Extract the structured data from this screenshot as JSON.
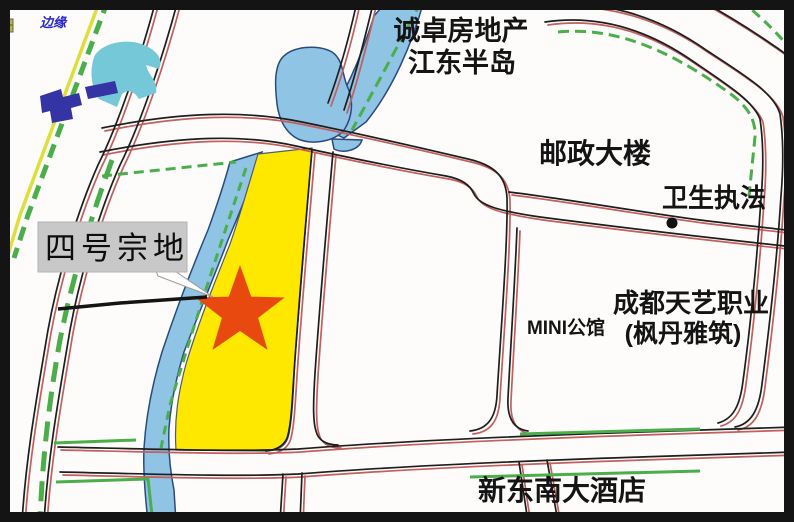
{
  "map": {
    "legend": {
      "label": "边缘"
    },
    "parcel": {
      "name": "四号宗地"
    },
    "pois": {
      "developer": {
        "line1": "诚卓房地产",
        "line2": "江东半岛"
      },
      "post_office": "邮政大楼",
      "health_enforcement": "卫生执法",
      "mini_mansion": "MINI公馆",
      "tianyi_college": {
        "line1": "成都天艺职业",
        "line2": "(枫丹雅筑)"
      },
      "hotel": "新东南大酒店"
    },
    "colors": {
      "parcel_fill": "#ffe800",
      "star": "#e8490f",
      "water": "#8fc4e4",
      "road_red": "#c25f5f",
      "road_black": "#1e1e1e",
      "vegetation_green": "#4aae4a",
      "boundary_yellow": "#dede3c",
      "label_box_gray": "#c8c8c8",
      "legend_text_blue": "#2828cc"
    }
  }
}
